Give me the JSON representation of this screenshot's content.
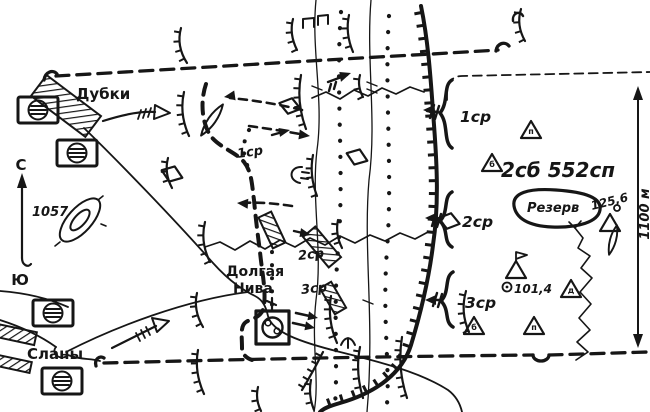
{
  "map": {
    "places": {
      "dubki": "Дубки",
      "slany": "Сланы",
      "dolgaya_line1": "Долгая",
      "dolgaya_line2": "Нива"
    },
    "unit": {
      "battalion": "2сб 552сп",
      "reserve": "Резерв"
    },
    "companies": {
      "c1": "1ср",
      "c2": "2ср",
      "c3": "3ср"
    },
    "elevations": {
      "hill": "1057",
      "spot1": "125,6",
      "spot2": "101,4"
    },
    "compass": {
      "north": "С",
      "south": "Ю"
    },
    "frontage_depth": "1100 м",
    "triangle_markers": {
      "m1": "п",
      "m2": "б",
      "m3": "д",
      "m4": "б",
      "m5": "п"
    },
    "ink_color": "#161616",
    "paper_color": "#ffffff"
  }
}
